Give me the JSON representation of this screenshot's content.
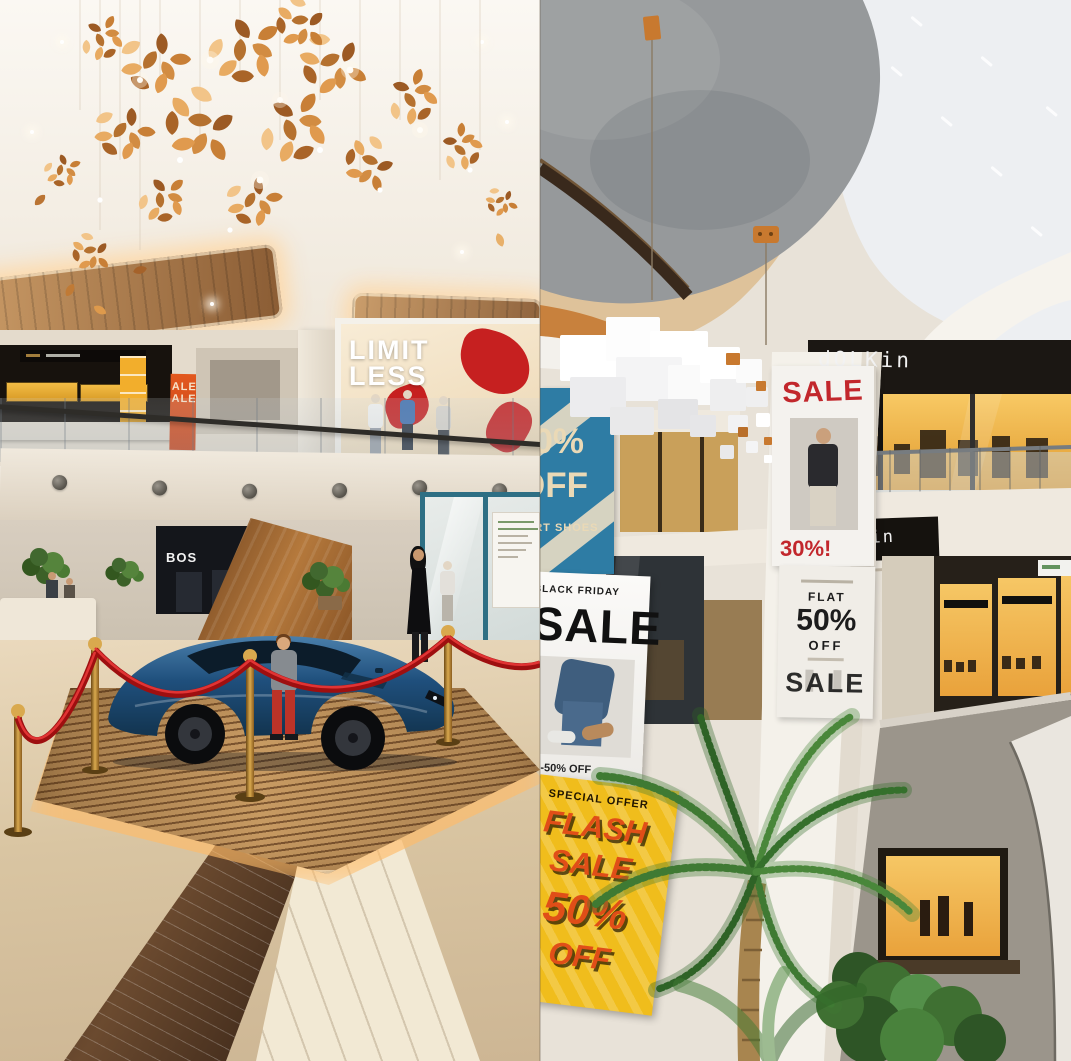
{
  "left": {
    "limitless": {
      "line1": "LIMIT",
      "line2": "LESS"
    },
    "boss": "BOS",
    "vertical_sale": {
      "line1": "SALE",
      "line2": "SALE"
    }
  },
  "right": {
    "dolkin_upper": "dOLKin",
    "dolkin_lower": "LKin",
    "sale_poster": {
      "title": "SALE",
      "discount": "30%!"
    },
    "flat_poster": {
      "label": "FLAT",
      "value": "50%",
      "unit": "OFF",
      "footer": "SALE"
    },
    "blue_banner": {
      "value": "50%",
      "unit": "OFF",
      "caption": "SPORT SHOES"
    },
    "black_friday": {
      "header": "BLACK FRIDAY",
      "title": "SALE",
      "footer": "20-50% OFF"
    },
    "flash_sale": {
      "header": "SPECIAL OFFER",
      "word1": "FLASH",
      "word2": "SALE",
      "word3": "50%",
      "word4": "OFF"
    }
  }
}
